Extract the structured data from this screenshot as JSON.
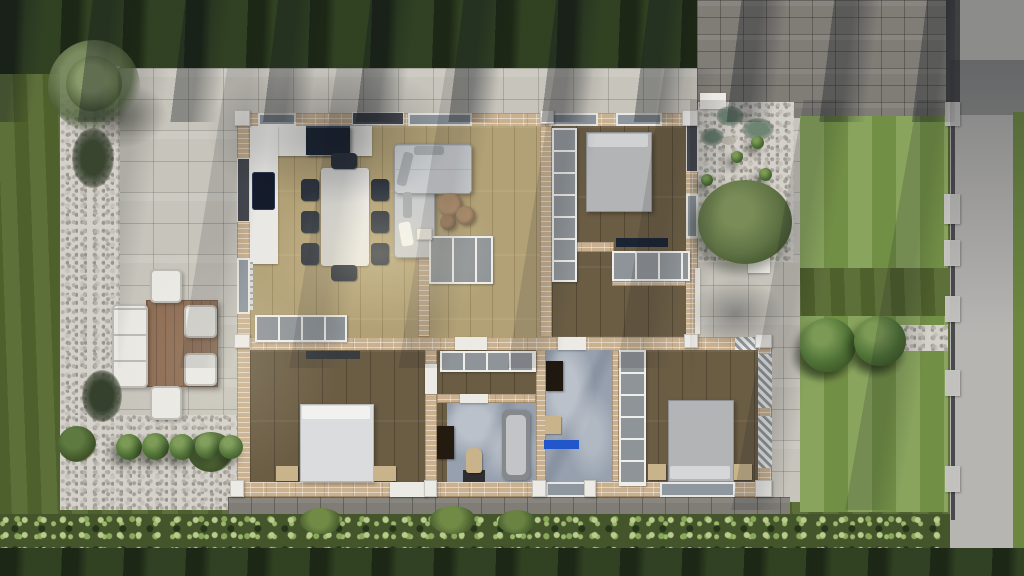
{
  "scene": {
    "description": "Top-down 3D architectural rendering of a single-storey house floor plan with furnished rooms, surrounding patio, gravel beds, lawns, hedge, driveway and street",
    "view": "top-down render, no visible text",
    "colors": {
      "lawn_mid": "#55682f",
      "lawn_dark": "#2b3a20",
      "lawn_bright": "#7b9a4b",
      "lawn_edge": "#6c8840",
      "patio_paver": "#c7c4bb",
      "driveway_dark": "#807d77",
      "path_dark": "#6f6b64",
      "road": "#b6b5b2",
      "road_slab": "#8c8c8a",
      "gravel": "#d4d1ca",
      "brick_wall": "#c9b190",
      "wood_light": "#b2a176",
      "wood_dark": "#6b5d44",
      "marble": "#96a0ae",
      "counter_white": "#e9e8e4",
      "appliance_navy": "#1b2433",
      "unit_gray": "#8f9498",
      "sofa_gray": "#c9ccce",
      "bed_white": "#dadcdd",
      "bed_gray": "#b2b4b6",
      "chair_dark": "#2d343f",
      "table_brown": "#8a6950",
      "outdoor_white": "#e9e8e3",
      "hedge_green": "#44552c",
      "bush_green": "#4e7136",
      "accent_blue": "#2257cb",
      "nightstand_tan": "#c9b38a",
      "fence_gray": "#c2c1be",
      "wall_white": "#eceae5",
      "glass_dark": "#45494f",
      "glass_gray": "#8f979e"
    },
    "outdoor_areas": [
      "front-lawn-strip",
      "left-lawn",
      "paved-patio",
      "gravel-borders",
      "outdoor-dining-terrace",
      "driveway",
      "street-with-fence",
      "right-lawn-front",
      "right-lawn-back",
      "boxwood-row",
      "hedge",
      "back-lawn"
    ],
    "rooms": [
      "living-dining-kitchen",
      "bedroom-top-right",
      "study-foyer",
      "hallway",
      "bedroom-bottom-left",
      "bathroom-main",
      "bathroom-second",
      "bedroom-bottom-right"
    ],
    "furniture": [
      "kitchen-counter",
      "cooktop",
      "extractor-island",
      "dining-table-eight-chairs",
      "corner-sofa",
      "round-coffee-tables",
      "sideboard",
      "wardrobes",
      "beds",
      "nightstands",
      "desk",
      "closet-rows",
      "bathtub",
      "toilet",
      "vanities",
      "shower-stool",
      "blue-bath-mat",
      "outdoor-table",
      "outdoor-bench",
      "outdoor-chairs"
    ]
  }
}
